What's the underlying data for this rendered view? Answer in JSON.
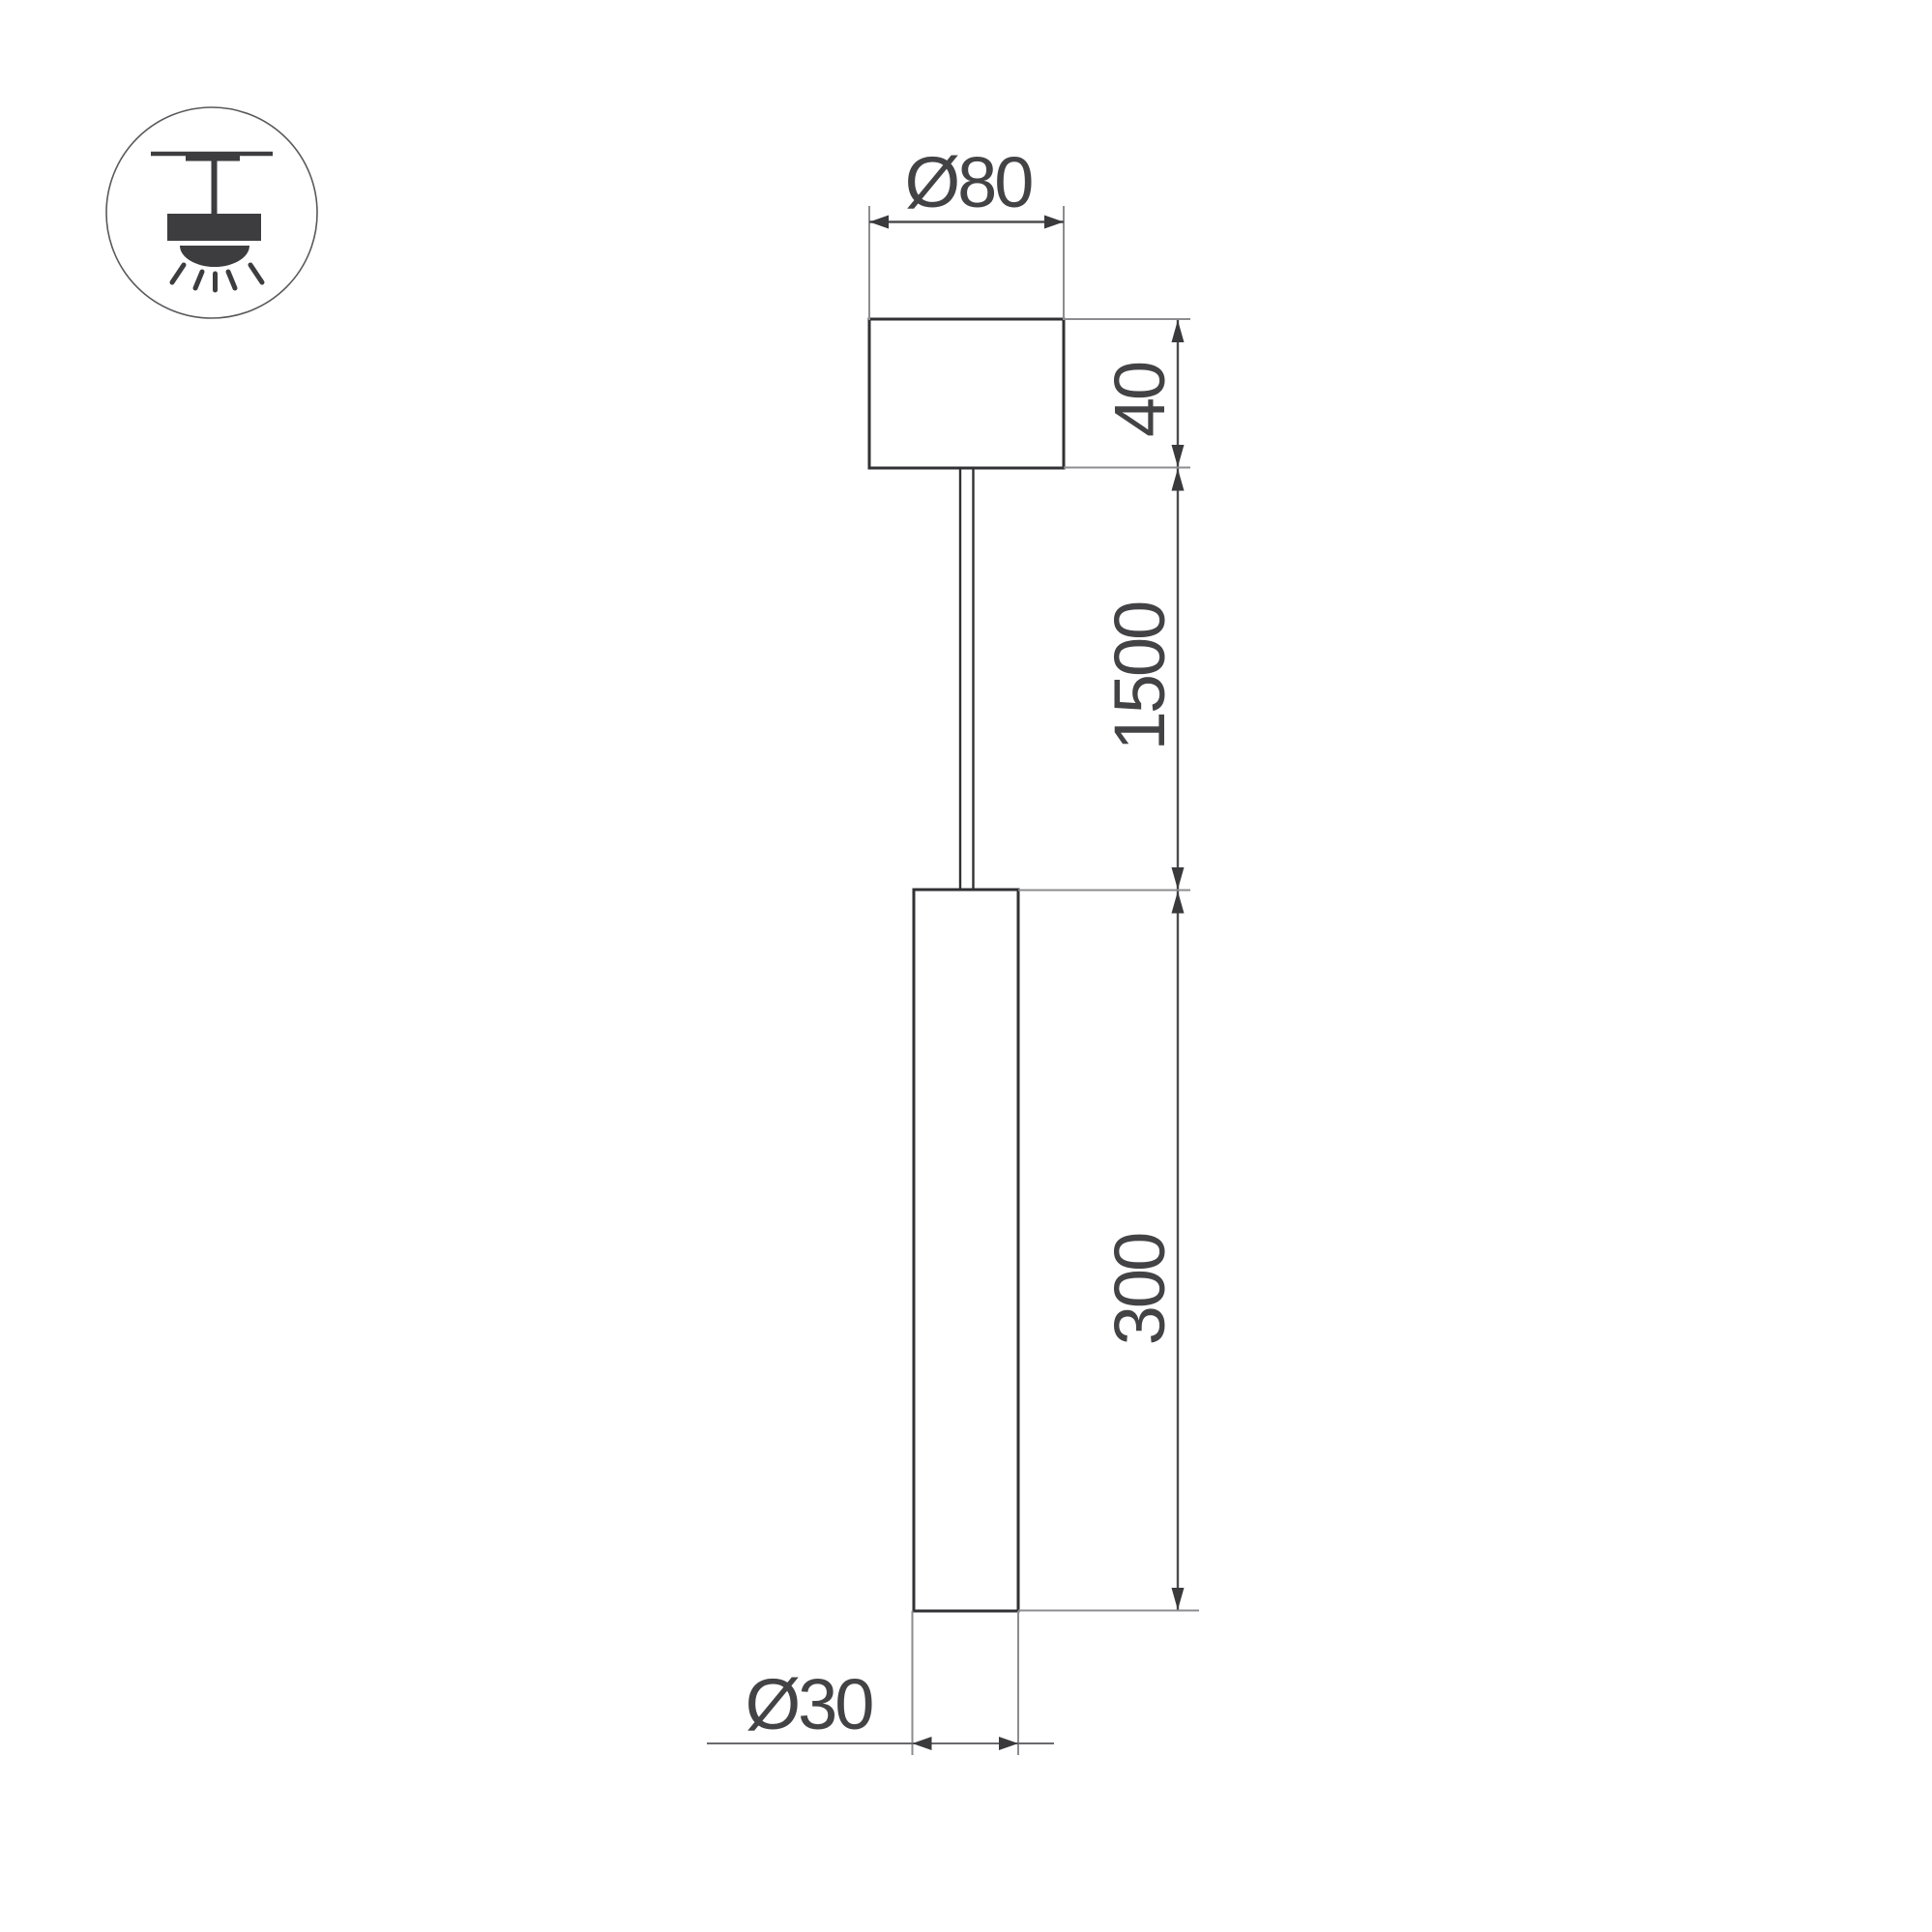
{
  "icon": {
    "name": "pendant-ceiling-light-icon"
  },
  "dimensions": {
    "canopy_diameter": "Ø80",
    "canopy_height": "40",
    "suspension_length": "1500",
    "tube_length": "300",
    "tube_diameter": "Ø30"
  },
  "colors": {
    "background": "#ffffff",
    "object_line": "#313134",
    "dimension_line": "#8d8d90",
    "dimension_chain_line": "#4d4d50",
    "arrow": "#3a3a3d",
    "text_color": "#434346",
    "icon_color": "#3d3d40",
    "icon_ring": "#59595d"
  }
}
